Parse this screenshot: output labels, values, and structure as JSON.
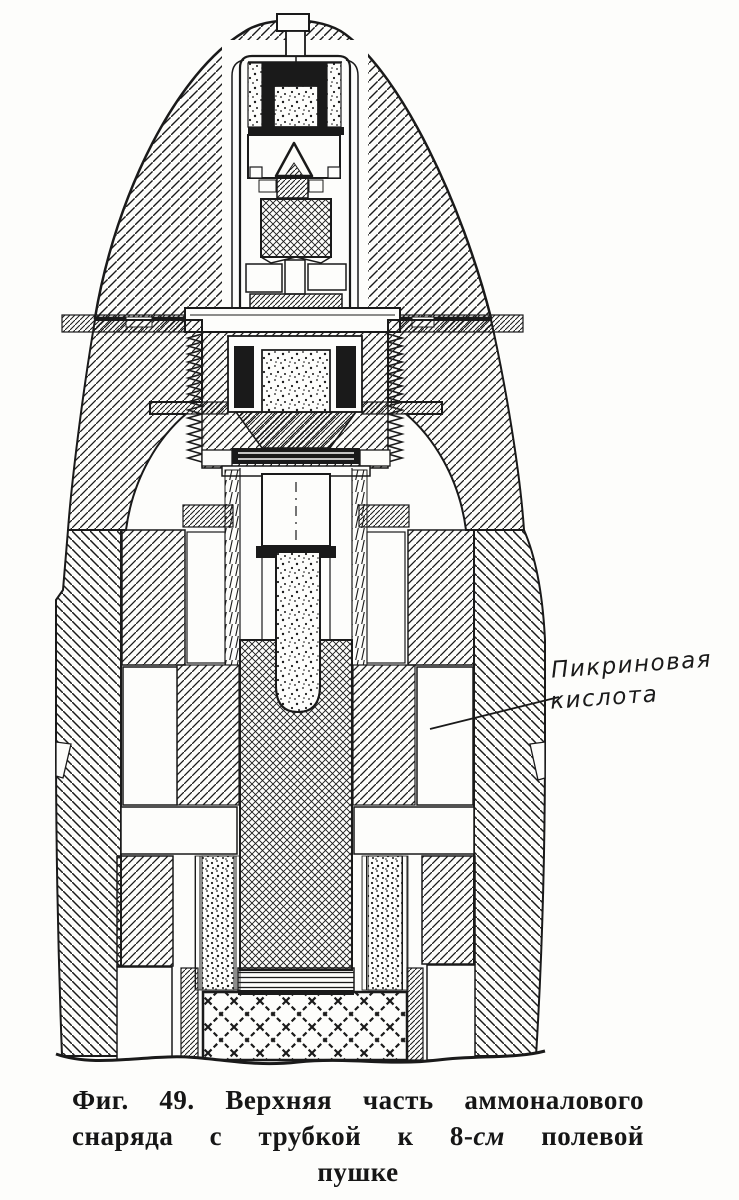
{
  "page": {
    "paper_color": "#fdfdfb",
    "ink_color": "#1a1a1a"
  },
  "figure": {
    "annotation": {
      "line1": "Пикриновая",
      "line2": "кислота"
    },
    "caption": {
      "number": "Фиг. 49.",
      "line1_text": "Верхняя часть аммоналового",
      "line2_start": "снаряда с трубкой к 8-",
      "line2_italic": "см",
      "line2_end": "полевой",
      "line3": "пушке"
    }
  }
}
